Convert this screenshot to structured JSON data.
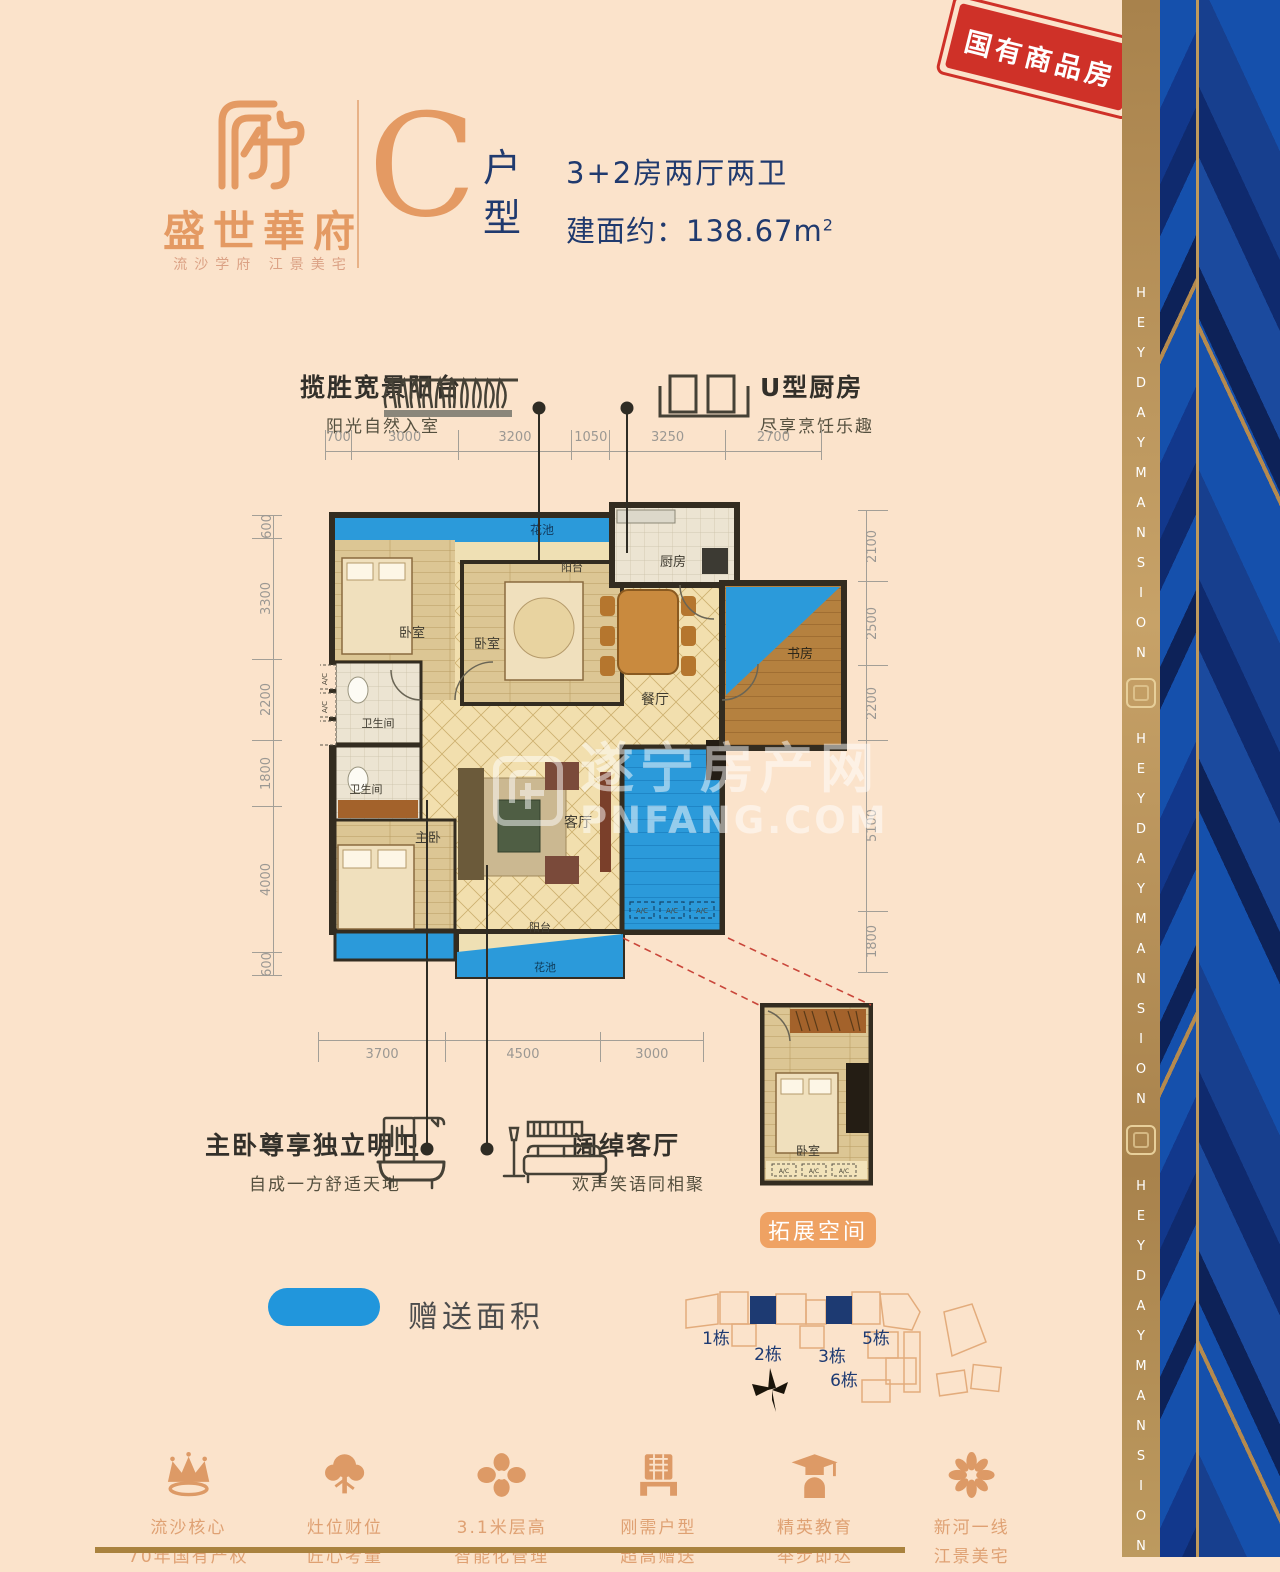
{
  "header": {
    "brand": "盛世華府",
    "tagline": "流沙学府 江景美宅",
    "unit_letter": "C",
    "unit_suffix_top": "户",
    "unit_suffix_bottom": "型",
    "line1": "3+2房两厅两卫",
    "line2": "建面约：138.67m",
    "line2_sup": "2",
    "stamp": "国有商品房"
  },
  "banner": {
    "text": "HEYDAYMANSION"
  },
  "callouts": {
    "balcony": {
      "title": "揽胜宽景阳台",
      "subtitle": "阳光自然入室"
    },
    "kitchen": {
      "title": "U型厨房",
      "subtitle": "尽享烹饪乐趣"
    },
    "master": {
      "title": "主卧尊享独立明卫",
      "subtitle": "自成一方舒适天地"
    },
    "living": {
      "title": "阔绰客厅",
      "subtitle": "欢声笑语同相聚"
    }
  },
  "plan": {
    "rooms": {
      "flower_top": "花池",
      "balcony_top": "阳台",
      "bedroom1": "卧室",
      "bedroom2": "卧室",
      "kitchen": "厨房",
      "study": "书房",
      "dining": "餐厅",
      "bath1": "卫生间",
      "bath2": "卫生间",
      "master": "主卧",
      "living": "客厅",
      "balcony_bottom": "阳台",
      "flower_bottom": "花池",
      "ext_bedroom": "卧室"
    },
    "ac_label": "A/C",
    "dimensions": {
      "top": [
        700,
        3000,
        3200,
        1050,
        3250,
        2700
      ],
      "left": [
        600,
        3300,
        2200,
        1800,
        4000,
        600
      ],
      "right": [
        2100,
        2500,
        2200,
        5100,
        1800
      ],
      "bottom": [
        3700,
        4500,
        3000
      ]
    },
    "extension_label": "拓展空间"
  },
  "legend": {
    "gift_label": "赠送面积",
    "gift_color": "#2196dc"
  },
  "siteplan": {
    "buildings": [
      "1栋",
      "2栋",
      "3栋",
      "5栋",
      "6栋"
    ]
  },
  "features": [
    {
      "line1": "流沙核心",
      "line2": "70年国有产权"
    },
    {
      "line1": "灶位财位",
      "line2": "匠心考量"
    },
    {
      "line1": "3.1米层高",
      "line2": "智能化管理"
    },
    {
      "line1": "刚需户型",
      "line2": "超高赠送"
    },
    {
      "line1": "精英教育",
      "line2": "举步即达"
    },
    {
      "line1": "新河一线",
      "line2": "江景美宅"
    }
  ],
  "watermark": {
    "title": "遂宁房产网",
    "url": "PNFANG.COM"
  },
  "colors": {
    "background": "#fbe3cb",
    "accent_orange": "#e49a63",
    "navy": "#203a6e",
    "gift_blue": "#2196dc",
    "stamp_red": "#cf3128",
    "gold": "#a9823e"
  }
}
